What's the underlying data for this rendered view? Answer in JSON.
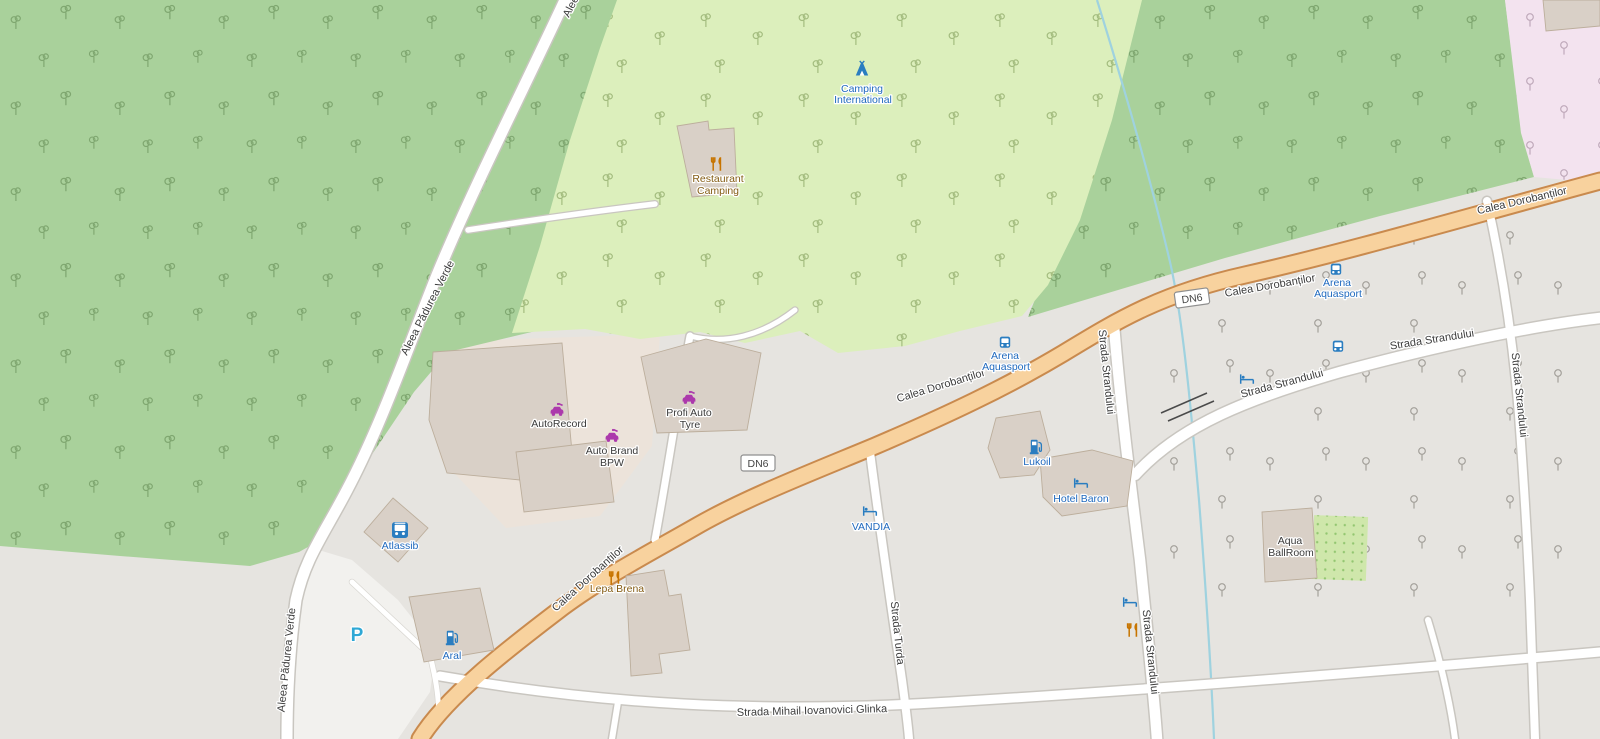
{
  "roads": {
    "calea_dorobantilor": "Calea Dorobanților",
    "dn6": "DN6",
    "aleea_padurea_verde": "Aleea Pădurea Verde",
    "strada_strandului": "Strada Strandului",
    "strada_turda": "Strada Turda",
    "strada_mihail_iovanovici_glinka": "Strada Mihail Iovanovici Glinka"
  },
  "pois": {
    "camping_international": {
      "line1": "Camping",
      "line2": "International"
    },
    "restaurant_camping": {
      "line1": "Restaurant",
      "line2": "Camping"
    },
    "profi_auto_tyre": {
      "line1": "Profi Auto",
      "line2": "Tyre"
    },
    "autorecord": {
      "label": "AutoRecord"
    },
    "auto_brand_bpw": {
      "line1": "Auto Brand",
      "line2": "BPW"
    },
    "atlassib": {
      "label": "Atlassib"
    },
    "aral": {
      "label": "Aral"
    },
    "parking": {
      "label": "P"
    },
    "lepa_brena": {
      "label": "Lepa Brena"
    },
    "vandia": {
      "label": "VANDIA"
    },
    "lukoil": {
      "label": "Lukoil"
    },
    "hotel_baron": {
      "label": "Hotel Baron"
    },
    "arena_aquasport": {
      "line1": "Arena",
      "line2": "Aquasport"
    },
    "aqua_ballroom": {
      "line1": "Aqua",
      "line2": "BallRoom"
    }
  },
  "colors": {
    "forest_green": "#a9d19b",
    "campground_green": "#dcefbc",
    "urban_gray": "#e6e4e0",
    "commercial_beige": "#ece3da",
    "pink_area": "#f3e3ef",
    "nursery_green": "#cfe7ab",
    "water_blue": "#9fd2df",
    "primary_road_fill": "#f8d29e",
    "primary_road_casing": "#c98a4e",
    "minor_road_fill": "#ffffff",
    "minor_road_casing": "#c9c6c0",
    "building_fill": "#d9d0c7",
    "building_stroke": "#bcae9c",
    "poi_blue": "#2a7dc0",
    "poi_blue_text": "#1f69be",
    "amenity_orange": "#c77400",
    "amenity_text": "#845c14",
    "shop_magenta": "#ac39ac",
    "dark_label": "#3a3a3a",
    "road_label": "#3c3c3c",
    "parking_blue": "#2fa8d5"
  }
}
